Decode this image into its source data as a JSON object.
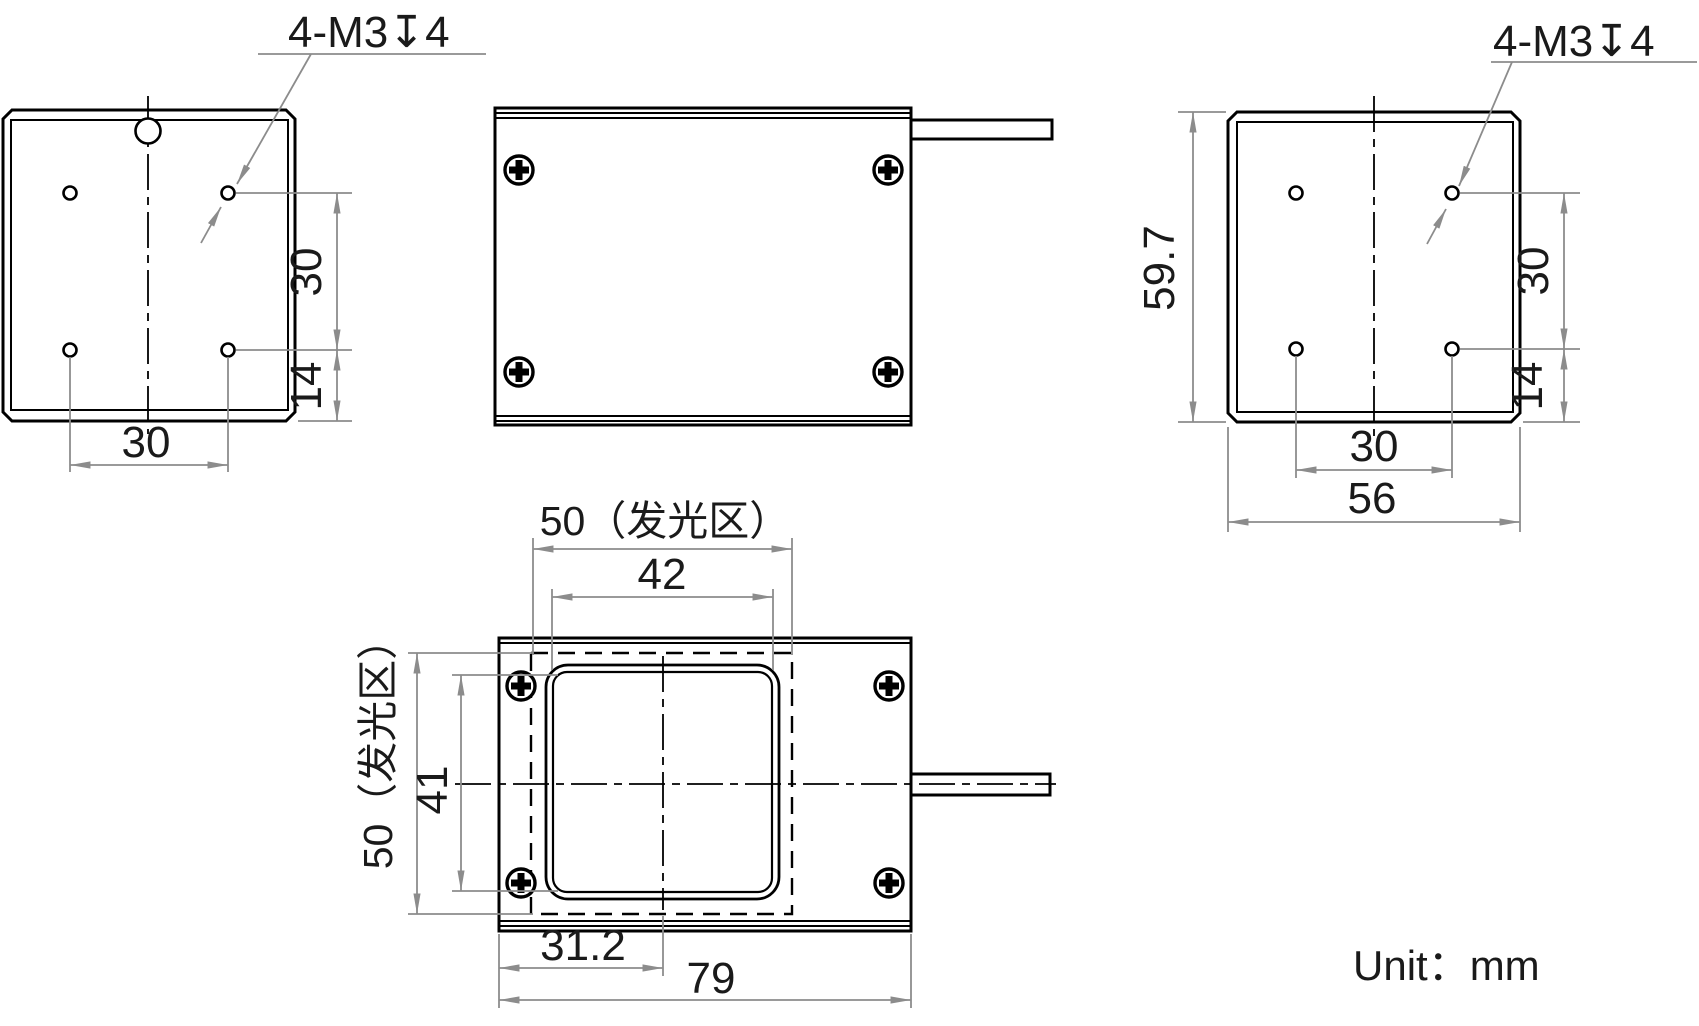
{
  "meta": {
    "unit_note": "Unit：mm"
  },
  "colors": {
    "object_line": "#000000",
    "dimension_line": "#8c8c8c",
    "text": "#1a1a1a"
  },
  "views": {
    "back_left": {
      "thread_label": "4-M3↧4",
      "hole_spacing_vertical": "30",
      "hole_to_bottom": "14",
      "hole_spacing_horizontal": "30"
    },
    "back_right": {
      "thread_label": "4-M3↧4",
      "body_height": "59.7",
      "hole_spacing_vertical": "30",
      "hole_to_bottom": "14",
      "hole_spacing_horizontal": "30",
      "body_width": "56"
    },
    "front": {
      "emitting_area_width": "50（发光区）",
      "window_width": "42",
      "emitting_area_height": "50（发光区）",
      "window_height": "41",
      "cable_axis_offset": "31.2",
      "body_width": "79"
    }
  }
}
